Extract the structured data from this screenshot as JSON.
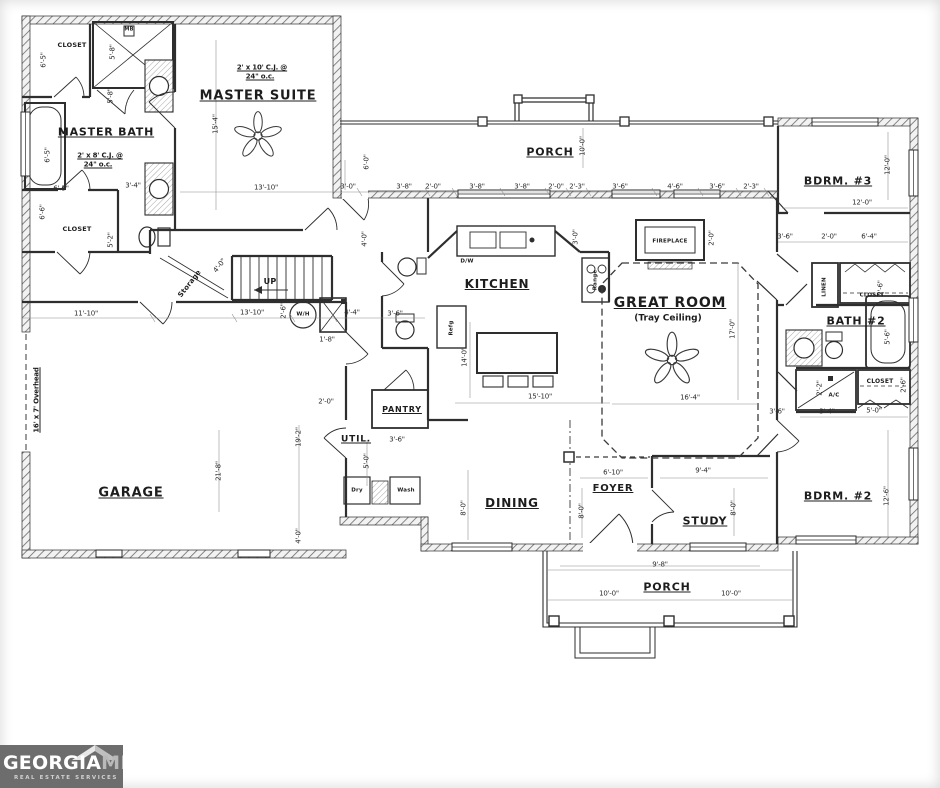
{
  "logo": {
    "georgia": "GEORGIA",
    "mls": "MLS",
    "tagline": "REAL ESTATE SERVICES",
    "bg_color": "#6d6d6d"
  },
  "plan": {
    "line_color": "#2e2e2e",
    "labels": [
      {
        "t": "MASTER SUITE",
        "x": 258,
        "y": 96,
        "c": "room",
        "s": 13
      },
      {
        "t": "MASTER BATH",
        "x": 106,
        "y": 132,
        "c": "room",
        "s": 11
      },
      {
        "t": "KITCHEN",
        "x": 497,
        "y": 284,
        "c": "room",
        "s": 12
      },
      {
        "t": "GREAT ROOM",
        "x": 670,
        "y": 303,
        "c": "room",
        "s": 14
      },
      {
        "t": "(Tray Ceiling)",
        "x": 668,
        "y": 319,
        "c": "sub",
        "s": 9
      },
      {
        "t": "PORCH",
        "x": 550,
        "y": 152,
        "c": "room",
        "s": 11
      },
      {
        "t": "BDRM. #3",
        "x": 838,
        "y": 181,
        "c": "room",
        "s": 11
      },
      {
        "t": "BATH #2",
        "x": 856,
        "y": 321,
        "c": "room",
        "s": 11
      },
      {
        "t": "BDRM. #2",
        "x": 838,
        "y": 496,
        "c": "room",
        "s": 11
      },
      {
        "t": "GARAGE",
        "x": 131,
        "y": 493,
        "c": "room",
        "s": 13
      },
      {
        "t": "DINING",
        "x": 512,
        "y": 503,
        "c": "room",
        "s": 12
      },
      {
        "t": "FOYER",
        "x": 613,
        "y": 489,
        "c": "room",
        "s": 10
      },
      {
        "t": "STUDY",
        "x": 705,
        "y": 521,
        "c": "room",
        "s": 11
      },
      {
        "t": "PORCH",
        "x": 667,
        "y": 587,
        "c": "room",
        "s": 11
      },
      {
        "t": "UTIL.",
        "x": 356,
        "y": 440,
        "c": "room",
        "s": 9
      },
      {
        "t": "PANTRY",
        "x": 402,
        "y": 410,
        "c": "room",
        "s": 8
      },
      {
        "t": "CLOSET",
        "x": 72,
        "y": 45,
        "c": "small",
        "s": 6.5
      },
      {
        "t": "CLOSET",
        "x": 77,
        "y": 229,
        "c": "small",
        "s": 6.5
      },
      {
        "t": "CLOSET",
        "x": 872,
        "y": 296,
        "c": "small",
        "s": 5.5
      },
      {
        "t": "CLOSET",
        "x": 880,
        "y": 382,
        "c": "small",
        "s": 6
      },
      {
        "t": "LINEN",
        "x": 825,
        "y": 287,
        "c": "small",
        "s": 5.5,
        "r": -90
      },
      {
        "t": "FIREPLACE",
        "x": 670,
        "y": 242,
        "c": "small",
        "s": 5.5
      },
      {
        "t": "Storage",
        "x": 190,
        "y": 284,
        "c": "small",
        "s": 7,
        "r": -52
      },
      {
        "t": "UP",
        "x": 270,
        "y": 282,
        "c": "small",
        "s": 8
      },
      {
        "t": "W/H",
        "x": 303,
        "y": 315,
        "c": "small",
        "s": 5.5
      },
      {
        "t": "A/C",
        "x": 834,
        "y": 396,
        "c": "small",
        "s": 5.5
      },
      {
        "t": "Dry",
        "x": 357,
        "y": 491,
        "c": "small",
        "s": 5.5
      },
      {
        "t": "Wash",
        "x": 406,
        "y": 491,
        "c": "small",
        "s": 5.5
      },
      {
        "t": "Range",
        "x": 596,
        "y": 280,
        "c": "small",
        "s": 5.5,
        "r": -90
      },
      {
        "t": "D/W",
        "x": 467,
        "y": 262,
        "c": "small",
        "s": 5.5
      },
      {
        "t": "Refg",
        "x": 452,
        "y": 328,
        "c": "small",
        "s": 5.5,
        "r": -90
      },
      {
        "t": "MB",
        "x": 129,
        "y": 30,
        "c": "small",
        "s": 5
      },
      {
        "t": "2' x 10' C.J. @",
        "x": 262,
        "y": 68,
        "c": "note"
      },
      {
        "t": "24\" o.c.",
        "x": 260,
        "y": 77,
        "c": "note"
      },
      {
        "t": "2' x 8' C.J. @",
        "x": 100,
        "y": 156,
        "c": "note"
      },
      {
        "t": "24\" o.c.",
        "x": 98,
        "y": 165,
        "c": "note"
      },
      {
        "t": "16' x 7' Overhead",
        "x": 37,
        "y": 400,
        "c": "note",
        "r": -90
      },
      {
        "t": "3'-0\"",
        "x": 348,
        "y": 187,
        "c": "dim"
      },
      {
        "t": "3'-8\"",
        "x": 404,
        "y": 187,
        "c": "dim"
      },
      {
        "t": "2'-0\"",
        "x": 433,
        "y": 187,
        "c": "dim"
      },
      {
        "t": "3'-8\"",
        "x": 477,
        "y": 187,
        "c": "dim"
      },
      {
        "t": "3'-8\"",
        "x": 522,
        "y": 187,
        "c": "dim"
      },
      {
        "t": "2'-0\"",
        "x": 556,
        "y": 187,
        "c": "dim"
      },
      {
        "t": "2'-3\"",
        "x": 577,
        "y": 187,
        "c": "dim"
      },
      {
        "t": "3'-6\"",
        "x": 620,
        "y": 187,
        "c": "dim"
      },
      {
        "t": "4'-6\"",
        "x": 675,
        "y": 187,
        "c": "dim"
      },
      {
        "t": "3'-6\"",
        "x": 717,
        "y": 187,
        "c": "dim"
      },
      {
        "t": "2'-3\"",
        "x": 751,
        "y": 187,
        "c": "dim"
      },
      {
        "t": "6'-0\"",
        "x": 367,
        "y": 162,
        "c": "dim",
        "r": -90
      },
      {
        "t": "10'-0\"",
        "x": 583,
        "y": 146,
        "c": "dim",
        "r": -90
      },
      {
        "t": "6'-5\"",
        "x": 44,
        "y": 60,
        "c": "dim",
        "r": -90
      },
      {
        "t": "5'-8\"",
        "x": 113,
        "y": 52,
        "c": "dim",
        "r": -90
      },
      {
        "t": "5'-8\"",
        "x": 111,
        "y": 96,
        "c": "dim",
        "r": -90
      },
      {
        "t": "15'-4\"",
        "x": 216,
        "y": 124,
        "c": "dim",
        "r": -90
      },
      {
        "t": "13'-10\"",
        "x": 266,
        "y": 188,
        "c": "dim"
      },
      {
        "t": "6'-5\"",
        "x": 48,
        "y": 155,
        "c": "dim",
        "r": -90
      },
      {
        "t": "6'-5\"",
        "x": 61,
        "y": 189,
        "c": "dim"
      },
      {
        "t": "6'-6\"",
        "x": 43,
        "y": 212,
        "c": "dim",
        "r": -90
      },
      {
        "t": "3'-4\"",
        "x": 133,
        "y": 186,
        "c": "dim"
      },
      {
        "t": "5'-2\"",
        "x": 111,
        "y": 240,
        "c": "dim",
        "r": -90
      },
      {
        "t": "4'-0\"",
        "x": 220,
        "y": 266,
        "c": "dim",
        "r": -52
      },
      {
        "t": "13'-10\"",
        "x": 252,
        "y": 313,
        "c": "dim"
      },
      {
        "t": "2'-6\"",
        "x": 284,
        "y": 311,
        "c": "dim",
        "r": -90
      },
      {
        "t": "4'-4\"",
        "x": 352,
        "y": 313,
        "c": "dim"
      },
      {
        "t": "1'-8\"",
        "x": 327,
        "y": 340,
        "c": "dim"
      },
      {
        "t": "11'-10\"",
        "x": 86,
        "y": 314,
        "c": "dim"
      },
      {
        "t": "4'-0\"",
        "x": 365,
        "y": 239,
        "c": "dim",
        "r": -90
      },
      {
        "t": "21'-8\"",
        "x": 219,
        "y": 471,
        "c": "dim",
        "r": -90
      },
      {
        "t": "19'-2\"",
        "x": 299,
        "y": 437,
        "c": "dim",
        "r": -90
      },
      {
        "t": "4'-0\"",
        "x": 299,
        "y": 536,
        "c": "dim",
        "r": -90
      },
      {
        "t": "3'-6\"",
        "x": 397,
        "y": 440,
        "c": "dim"
      },
      {
        "t": "5'-0\"",
        "x": 367,
        "y": 461,
        "c": "dim",
        "r": -90
      },
      {
        "t": "2'-0\"",
        "x": 326,
        "y": 402,
        "c": "dim"
      },
      {
        "t": "3'-6\"",
        "x": 395,
        "y": 314,
        "c": "dim"
      },
      {
        "t": "3'-0\"",
        "x": 576,
        "y": 237,
        "c": "dim",
        "r": -90
      },
      {
        "t": "2'-0\"",
        "x": 712,
        "y": 238,
        "c": "dim",
        "r": -90
      },
      {
        "t": "14'-0\"",
        "x": 465,
        "y": 357,
        "c": "dim",
        "r": -90
      },
      {
        "t": "15'-10\"",
        "x": 540,
        "y": 397,
        "c": "dim"
      },
      {
        "t": "16'-4\"",
        "x": 690,
        "y": 398,
        "c": "dim"
      },
      {
        "t": "17'-0\"",
        "x": 733,
        "y": 329,
        "c": "dim",
        "r": -90
      },
      {
        "t": "6'-10\"",
        "x": 613,
        "y": 473,
        "c": "dim"
      },
      {
        "t": "8'-0\"",
        "x": 582,
        "y": 511,
        "c": "dim",
        "r": -90
      },
      {
        "t": "9'-4\"",
        "x": 703,
        "y": 471,
        "c": "dim"
      },
      {
        "t": "8'-0\"",
        "x": 734,
        "y": 508,
        "c": "dim",
        "r": -90
      },
      {
        "t": "8'-0\"",
        "x": 464,
        "y": 508,
        "c": "dim",
        "r": -90
      },
      {
        "t": "12'-0\"",
        "x": 888,
        "y": 165,
        "c": "dim",
        "r": -90
      },
      {
        "t": "12'-0\"",
        "x": 862,
        "y": 203,
        "c": "dim"
      },
      {
        "t": "3'-6\"",
        "x": 785,
        "y": 237,
        "c": "dim"
      },
      {
        "t": "2'-0\"",
        "x": 829,
        "y": 237,
        "c": "dim"
      },
      {
        "t": "6'-4\"",
        "x": 869,
        "y": 237,
        "c": "dim"
      },
      {
        "t": "2'-6\"",
        "x": 881,
        "y": 288,
        "c": "dim",
        "r": -90
      },
      {
        "t": "5'-6\"",
        "x": 888,
        "y": 337,
        "c": "dim",
        "r": -90
      },
      {
        "t": "2'-6\"",
        "x": 904,
        "y": 385,
        "c": "dim",
        "r": -90
      },
      {
        "t": "2'-2\"",
        "x": 820,
        "y": 388,
        "c": "dim",
        "r": -90
      },
      {
        "t": "3'-4\"",
        "x": 827,
        "y": 412,
        "c": "dim"
      },
      {
        "t": "5'-0\"",
        "x": 874,
        "y": 411,
        "c": "dim"
      },
      {
        "t": "3'-6\"",
        "x": 777,
        "y": 412,
        "c": "dim"
      },
      {
        "t": "12'-6\"",
        "x": 887,
        "y": 496,
        "c": "dim",
        "r": -90
      },
      {
        "t": "9'-8\"",
        "x": 660,
        "y": 565,
        "c": "dim"
      },
      {
        "t": "10'-0\"",
        "x": 609,
        "y": 594,
        "c": "dim"
      },
      {
        "t": "10'-0\"",
        "x": 731,
        "y": 594,
        "c": "dim"
      }
    ]
  }
}
